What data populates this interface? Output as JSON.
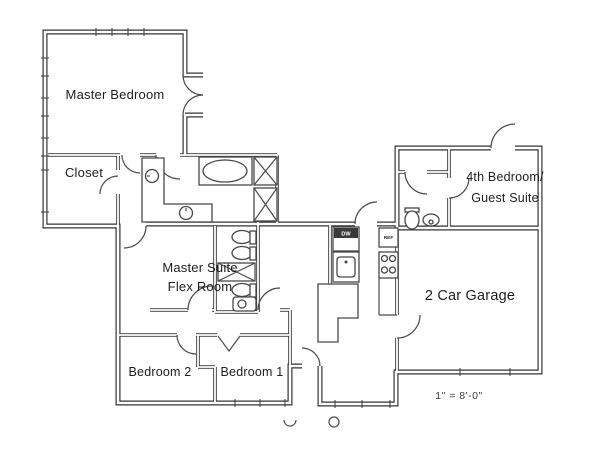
{
  "meta": {
    "drawing_type": "residential floor plan",
    "background_color": "#ffffff",
    "wall_color": "#323232",
    "text_color": "#1d1d1d"
  },
  "rooms": {
    "master_bedroom": {
      "label": "Master Bedroom"
    },
    "closet": {
      "label": "Closet"
    },
    "master_suite_flex": {
      "label_line1": "Master Suite",
      "label_line2": "Flex Room"
    },
    "bedroom2": {
      "label": "Bedroom 2"
    },
    "bedroom1": {
      "label": "Bedroom 1"
    },
    "guest_suite": {
      "label_line1": "4th Bedroom/",
      "label_line2": "Guest Suite"
    },
    "garage": {
      "label": "2 Car Garage"
    }
  },
  "appliances": {
    "dishwasher": "DW",
    "refrigerator": "REF"
  },
  "annotations": {
    "scale_note": "1\" = 8'-0\""
  },
  "icons": {
    "fixtures": [
      "bathtub-icon",
      "sink-icon",
      "toilet-icon",
      "stove-burners-icon",
      "linen-cabinet-x-icon",
      "door-swing-icon",
      "bifold-door-icon",
      "window-icon"
    ]
  }
}
